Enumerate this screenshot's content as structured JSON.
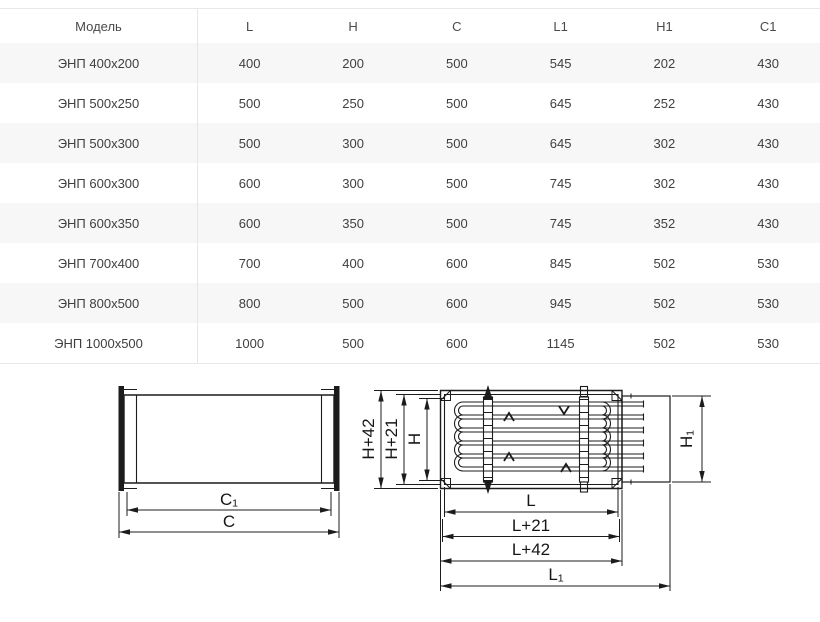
{
  "table": {
    "header": [
      "Модель",
      "L",
      "H",
      "C",
      "L1",
      "H1",
      "C1"
    ],
    "rows": [
      [
        "ЭНП 400x200",
        "400",
        "200",
        "500",
        "545",
        "202",
        "430"
      ],
      [
        "ЭНП 500x250",
        "500",
        "250",
        "500",
        "645",
        "252",
        "430"
      ],
      [
        "ЭНП 500x300",
        "500",
        "300",
        "500",
        "645",
        "302",
        "430"
      ],
      [
        "ЭНП 600x300",
        "600",
        "300",
        "500",
        "745",
        "302",
        "430"
      ],
      [
        "ЭНП 600x350",
        "600",
        "350",
        "500",
        "745",
        "352",
        "430"
      ],
      [
        "ЭНП 700x400",
        "700",
        "400",
        "600",
        "845",
        "502",
        "530"
      ],
      [
        "ЭНП 800x500",
        "800",
        "500",
        "600",
        "945",
        "502",
        "530"
      ],
      [
        "ЭНП 1000x500",
        "1000",
        "500",
        "600",
        "1145",
        "502",
        "530"
      ]
    ]
  },
  "diagrams": {
    "side_view": {
      "c1": "C₁",
      "c": "C"
    },
    "front_view": {
      "h_plus_42": "H+42",
      "h_plus_21": "H+21",
      "h": "H",
      "h1": "H₁",
      "l": "L",
      "l_plus_21": "L+21",
      "l_plus_42": "L+42",
      "l1": "L₁"
    }
  },
  "colors": {
    "line": "#1c1c1c",
    "table_text": "#3f3f3f",
    "row_stripe": "#f7f7f8",
    "table_border": "#e8e8e8"
  }
}
